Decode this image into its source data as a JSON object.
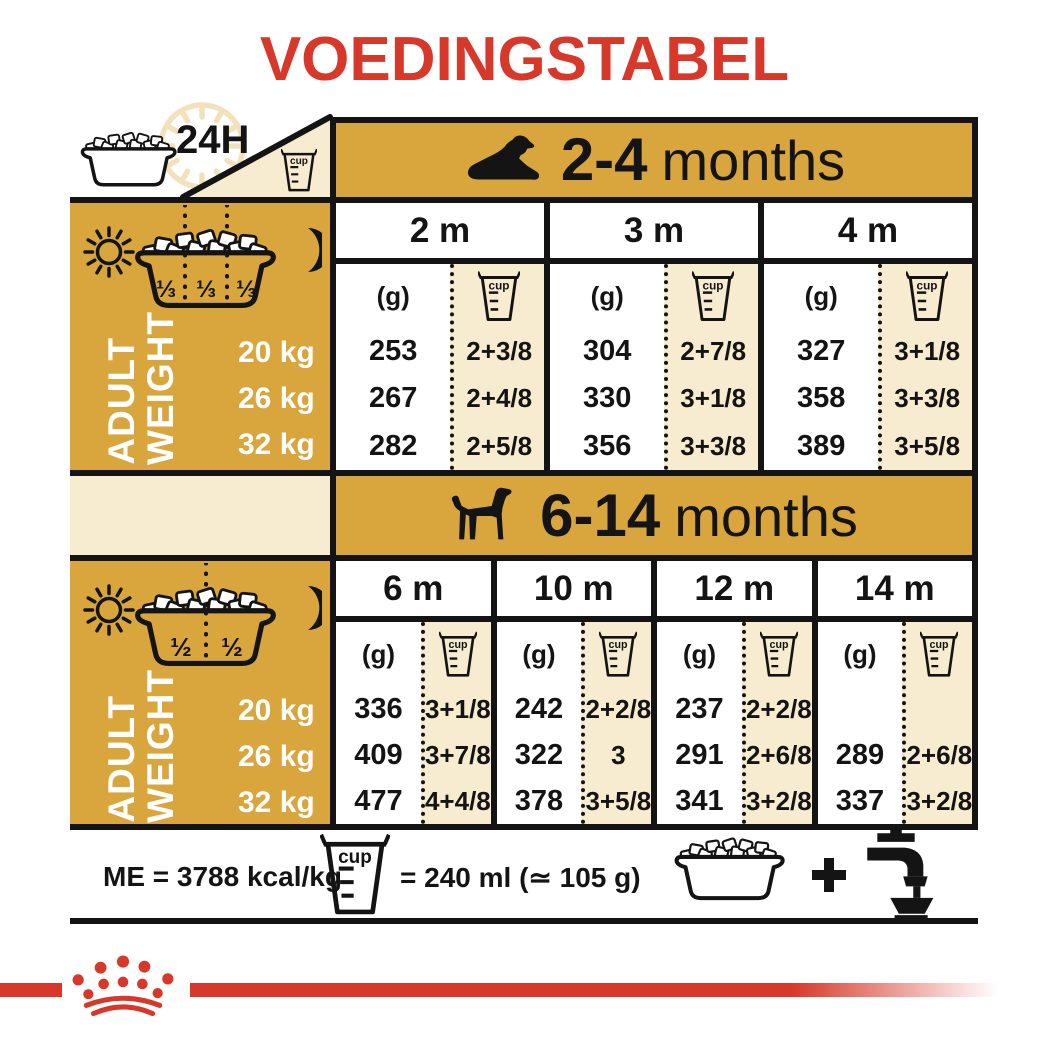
{
  "title": "VOEDINGSTABEL",
  "colors": {
    "gold": "#D9A63E",
    "cream": "#F7EBD0",
    "red": "#D8382A",
    "ink": "#141414"
  },
  "top": {
    "h24": "24H"
  },
  "shared": {
    "cup": "cup",
    "g": "(g)",
    "adult_line1": "ADULT",
    "adult_line2": "WEIGHT",
    "weights": [
      "20 kg",
      "26 kg",
      "32 kg"
    ]
  },
  "sections": [
    {
      "age_bold": "2-4",
      "age_rest": "months",
      "fractions": [
        "⅓",
        "⅓",
        "⅓"
      ],
      "months": [
        {
          "label": "2 m",
          "grams": [
            "253",
            "267",
            "282"
          ],
          "cups": [
            "2+3/8",
            "2+4/8",
            "2+5/8"
          ]
        },
        {
          "label": "3 m",
          "grams": [
            "304",
            "330",
            "356"
          ],
          "cups": [
            "2+7/8",
            "3+1/8",
            "3+3/8"
          ]
        },
        {
          "label": "4 m",
          "grams": [
            "327",
            "358",
            "389"
          ],
          "cups": [
            "3+1/8",
            "3+3/8",
            "3+5/8"
          ]
        }
      ]
    },
    {
      "age_bold": "6-14",
      "age_rest": "months",
      "fractions": [
        "½",
        "½"
      ],
      "months": [
        {
          "label": "6 m",
          "grams": [
            "336",
            "409",
            "477"
          ],
          "cups": [
            "3+1/8",
            "3+7/8",
            "4+4/8"
          ]
        },
        {
          "label": "10 m",
          "grams": [
            "242",
            "322",
            "378"
          ],
          "cups": [
            "2+2/8",
            "3",
            "3+5/8"
          ]
        },
        {
          "label": "12 m",
          "grams": [
            "237",
            "291",
            "341"
          ],
          "cups": [
            "2+2/8",
            "2+6/8",
            "3+2/8"
          ]
        },
        {
          "label": "14 m",
          "grams": [
            "",
            "289",
            "337"
          ],
          "cups": [
            "",
            "2+6/8",
            "3+2/8"
          ]
        }
      ]
    }
  ],
  "footer": {
    "me": "ME = 3788 kcal/kg",
    "cup_equiv": "= 240 ml (≃ 105 g)"
  }
}
